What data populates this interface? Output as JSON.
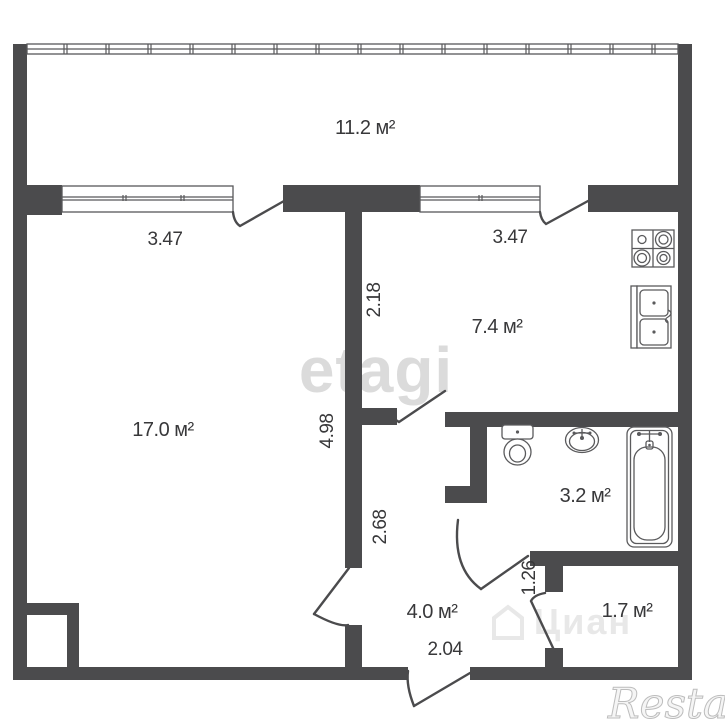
{
  "plan_title": "apartment-floor-plan",
  "rooms": {
    "balcony": {
      "area": "11.2 м²"
    },
    "living": {
      "area": "17.0 м²"
    },
    "kitchen": {
      "area": "7.4 м²"
    },
    "bathroom": {
      "area": "3.2 м²"
    },
    "hallway": {
      "area": "4.0 м²"
    },
    "storage": {
      "area": "1.7 м²"
    }
  },
  "dimensions": {
    "living_window_width": "3.47",
    "kitchen_window_width": "3.47",
    "kitchen_depth": "2.18",
    "living_depth": "4.98",
    "hallway_depth": "2.68",
    "storage_entry_width": "1.26",
    "hallway_width": "2.04"
  },
  "watermarks": {
    "etagi": "etagi",
    "cian": "Циан",
    "restate": "Restate"
  },
  "icons": [
    "stove-icon",
    "kitchen-sink-icon",
    "toilet-icon",
    "washbasin-icon",
    "bathtub-icon"
  ],
  "colors": {
    "wall": "#4b4b4d",
    "fixture_line": "#5a5a5c",
    "label_text": "#38383a",
    "watermark_light": "#d8d8d8",
    "background": "#ffffff"
  }
}
